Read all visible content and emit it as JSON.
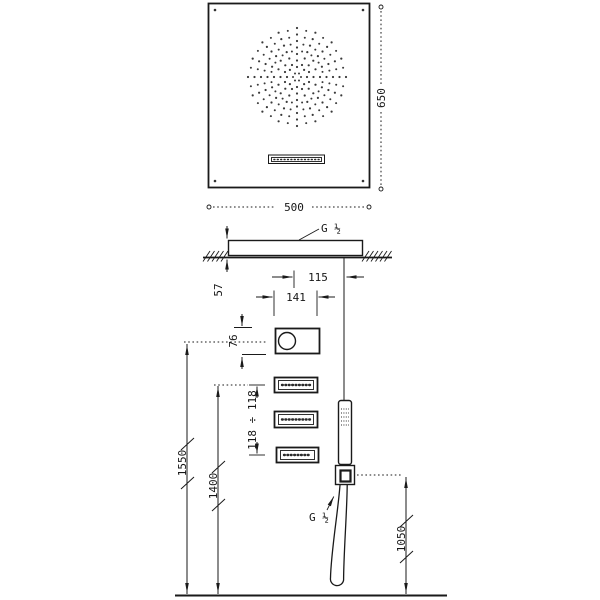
{
  "drawing": {
    "type": "shower-system-installation-diagram",
    "colors": {
      "line": "#1a1a1a",
      "background": "#ffffff"
    },
    "labels": {
      "front_width": "500",
      "front_height": "650",
      "profile_depth": "57",
      "ceiling_inlet_thread": "G ½",
      "control_offset": "115",
      "control_width": "141",
      "control_height": "76",
      "jet_spacing": "118 ÷ 118",
      "control_mount_height": "1550",
      "jet_mount_height": "1400",
      "handshower_mount_height": "1050",
      "handshower_thread": "G ½"
    }
  }
}
